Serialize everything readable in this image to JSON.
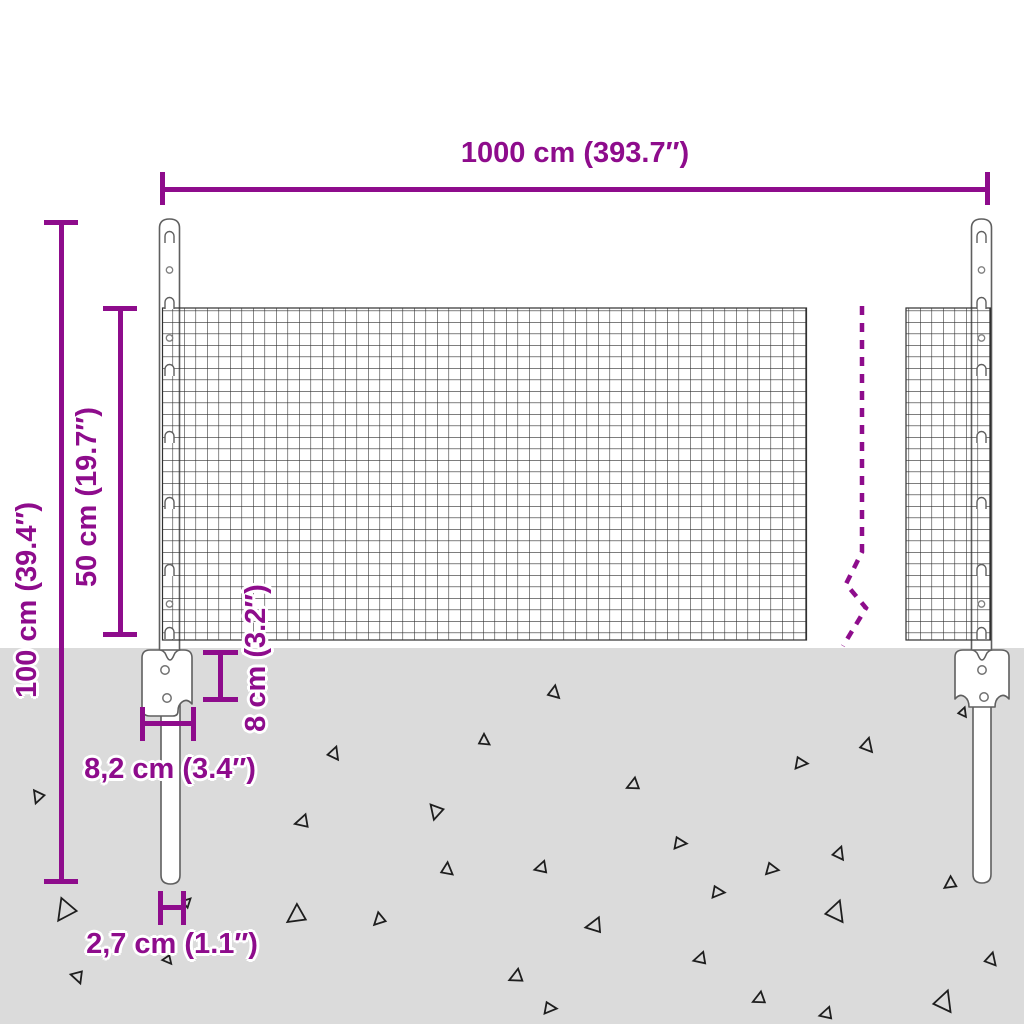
{
  "title": "Wire mesh fence with posts - dimension diagram",
  "colors": {
    "accent": "#8E0C8C",
    "ground": "#DBDBDB",
    "mesh_line": "#303030",
    "structure_outline": "#5F5F5F",
    "gravel": "#1E1E1E",
    "background": "#FFFFFF"
  },
  "labels": {
    "total_width": "1000 cm (393.7″)",
    "total_height": "100 cm (39.4″)",
    "mesh_height": "50 cm (19.7″)",
    "bracket_height": "8 cm (3.2″)",
    "bracket_width": "8,2 cm (3.4″)",
    "post_diameter": "2,7 cm (1.1″)"
  },
  "posts": {
    "left_x": 169.5,
    "right_x": 981.5,
    "hook_offsets_y": [
      237,
      303,
      370,
      437,
      503,
      570,
      633
    ],
    "hole_offsets_y": [
      270,
      338,
      604
    ],
    "bracket_holes": [
      {
        "x": 165,
        "y": 670
      },
      {
        "x": 167,
        "y": 698
      },
      {
        "x": 982,
        "y": 670
      },
      {
        "x": 984,
        "y": 697
      }
    ]
  },
  "ground": {
    "triangles": [
      {
        "x": 38,
        "y": 797,
        "s": 11,
        "r": 200
      },
      {
        "x": 65,
        "y": 911,
        "s": 19,
        "r": 215
      },
      {
        "x": 78,
        "y": 977,
        "s": 11,
        "r": 160
      },
      {
        "x": 168,
        "y": 960,
        "s": 8,
        "r": 140
      },
      {
        "x": 187,
        "y": 902,
        "s": 8,
        "r": 45
      },
      {
        "x": 296,
        "y": 916,
        "s": 17,
        "r": 235
      },
      {
        "x": 334,
        "y": 753,
        "s": 11,
        "r": 20
      },
      {
        "x": 302,
        "y": 822,
        "s": 12,
        "r": 255
      },
      {
        "x": 379,
        "y": 920,
        "s": 11,
        "r": 225
      },
      {
        "x": 436,
        "y": 812,
        "s": 13,
        "r": 195
      },
      {
        "x": 447,
        "y": 869,
        "s": 11,
        "r": 5
      },
      {
        "x": 484,
        "y": 740,
        "s": 10,
        "r": 0
      },
      {
        "x": 516,
        "y": 977,
        "s": 12,
        "r": 245
      },
      {
        "x": 541,
        "y": 868,
        "s": 11,
        "r": 255
      },
      {
        "x": 554,
        "y": 692,
        "s": 11,
        "r": 10
      },
      {
        "x": 594,
        "y": 926,
        "s": 14,
        "r": 260
      },
      {
        "x": 633,
        "y": 785,
        "s": 11,
        "r": 245
      },
      {
        "x": 680,
        "y": 843,
        "s": 11,
        "r": 95
      },
      {
        "x": 700,
        "y": 959,
        "s": 11,
        "r": 255
      },
      {
        "x": 718,
        "y": 892,
        "s": 11,
        "r": 95
      },
      {
        "x": 759,
        "y": 999,
        "s": 11,
        "r": 245
      },
      {
        "x": 772,
        "y": 869,
        "s": 11,
        "r": 100
      },
      {
        "x": 801,
        "y": 763,
        "s": 11,
        "r": 95
      },
      {
        "x": 826,
        "y": 1014,
        "s": 11,
        "r": 255
      },
      {
        "x": 836,
        "y": 911,
        "s": 18,
        "r": 20
      },
      {
        "x": 839,
        "y": 853,
        "s": 11,
        "r": 20
      },
      {
        "x": 867,
        "y": 745,
        "s": 12,
        "r": 15
      },
      {
        "x": 944,
        "y": 1001,
        "s": 18,
        "r": 20
      },
      {
        "x": 950,
        "y": 884,
        "s": 11,
        "r": 235
      },
      {
        "x": 963,
        "y": 712,
        "s": 8,
        "r": 20
      },
      {
        "x": 991,
        "y": 959,
        "s": 11,
        "r": 15
      },
      {
        "x": 550,
        "y": 1008,
        "s": 11,
        "r": 95
      }
    ]
  }
}
